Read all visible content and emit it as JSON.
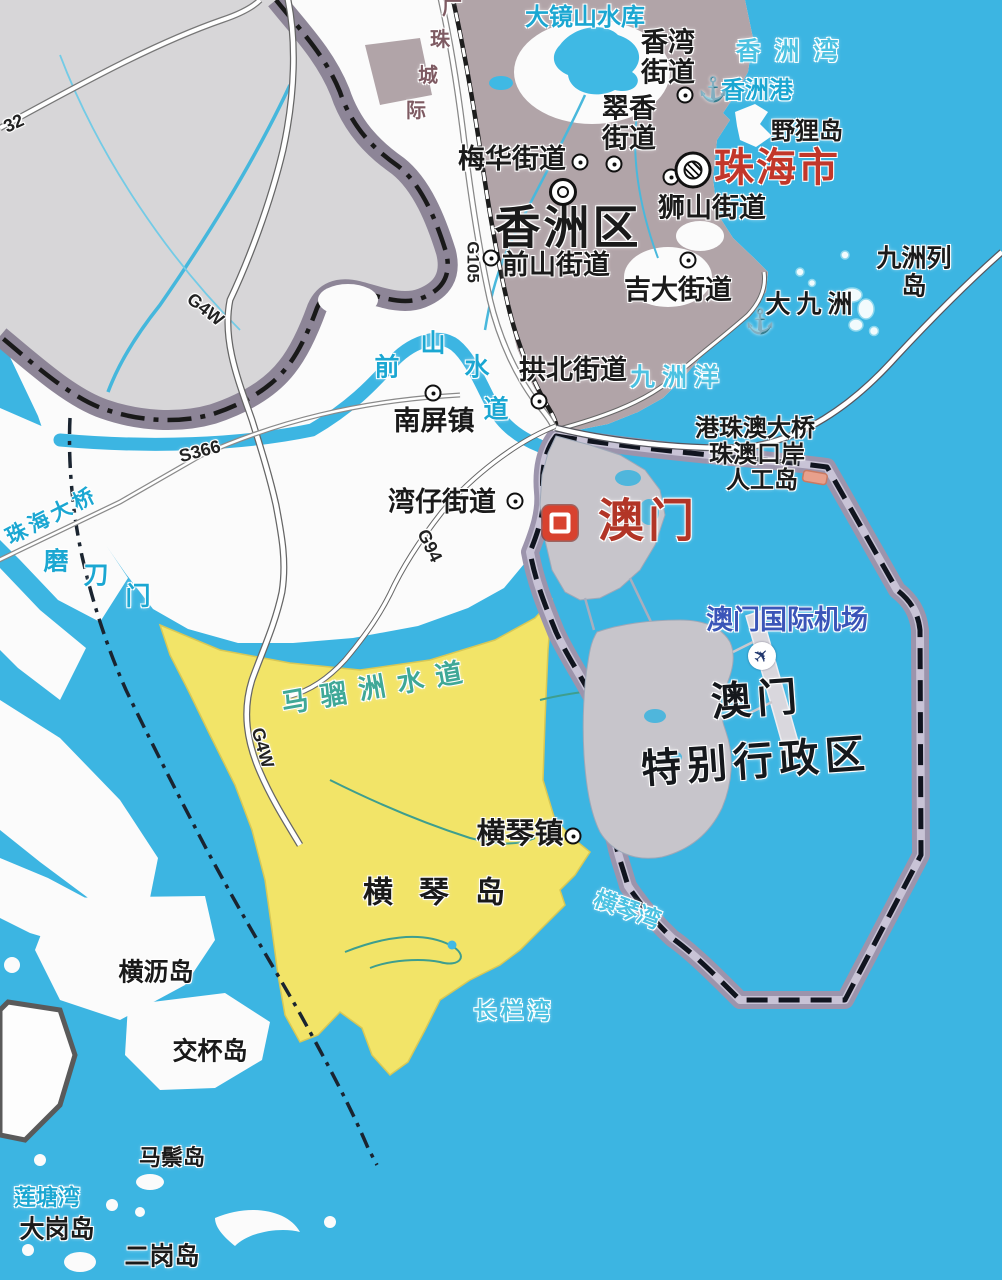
{
  "map": {
    "city": {
      "name": "珠海市"
    },
    "district": {
      "name": "香洲区"
    },
    "streets": {
      "xiangwan": "香湾\n街道",
      "cuixiang": "翠香\n街道",
      "meihua": "梅华街道",
      "shishan": "狮山街道",
      "qianshan": "前山街道",
      "jida": "吉大街道",
      "gongbei": "拱北街道",
      "nanping": "南屏镇",
      "wanzai": "湾仔街道",
      "hengqin": "横琴镇"
    },
    "macau": {
      "name": "澳门",
      "sar_line1": "澳门",
      "sar_line2": "特别行政区",
      "airport": "澳门国际机场"
    },
    "islands": {
      "yeli": "野狸岛",
      "dajiuzhou": "大九洲",
      "jiuzhou_liedao": "九洲列岛",
      "hengqin_dao": "横琴岛",
      "hengli": "横沥岛",
      "jiaobei": "交杯岛",
      "mazong": "马鬃岛",
      "dagang": "大岗岛",
      "ergang": "二岗岛"
    },
    "waters": {
      "dajingshan": "大镜山水库",
      "xiangzhou_wan": "香洲湾",
      "xiangzhou_gang": "香洲港",
      "jiuzhou_yang": "九洲洋",
      "qianshan_chars": [
        "前",
        "山",
        "水",
        "道"
      ],
      "modaomen_chars": [
        "磨",
        "刀",
        "门"
      ],
      "maliuzhou": "马骝洲水道",
      "liantang_wan": "莲塘湾",
      "hengqin_wan": "横琴湾",
      "changlan_wan": "长栏湾"
    },
    "bridges": {
      "hzmb": "港珠澳大桥",
      "port": "珠澳口岸",
      "artificial_island": "人工岛",
      "zhuhai_bridge": "珠海大桥"
    },
    "roads": {
      "g4w": "G4W",
      "s366": "S366",
      "g94": "G94",
      "g105": "G105",
      "r32": "32",
      "rail_chars": [
        "广",
        "珠",
        "城",
        "际"
      ]
    },
    "icons": {
      "anchor": "⚓",
      "plane": "✈"
    },
    "colors": {
      "sea": "#3CB5E2",
      "land_white": "#FBFBFB",
      "land_gray": "#D7D6D8",
      "urban": "#B1A4A8",
      "hengqin_yellow": "#F2E468",
      "macau_gray": "#C7C5CB",
      "district_band": "#8D8597",
      "sar_band": "#9C94AC",
      "city_red": "#C2372A",
      "water_text": "#1BA7D2"
    }
  }
}
